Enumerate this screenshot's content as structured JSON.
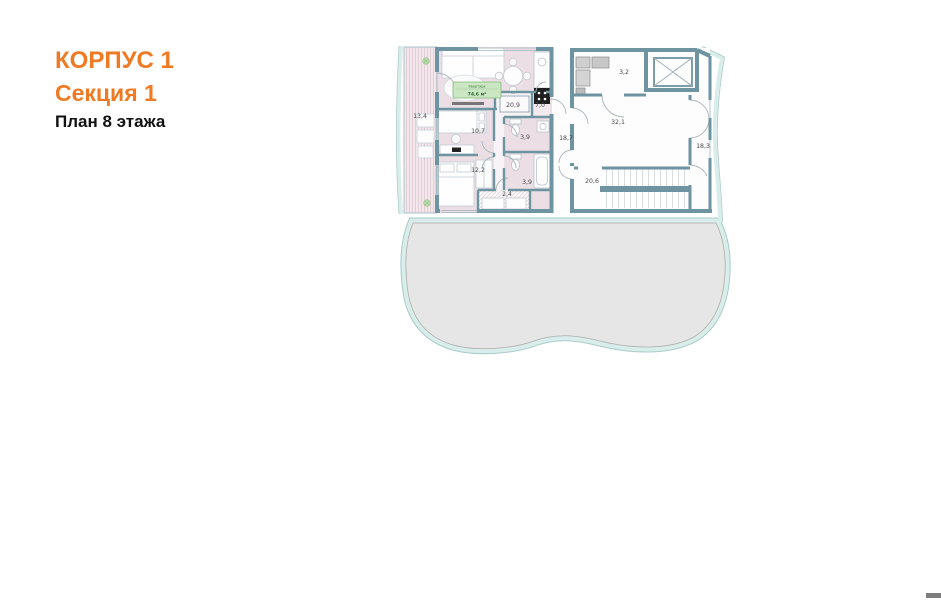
{
  "header": {
    "building": "КОРПУС 1",
    "section": "Секция 1",
    "floor": "План 8 этажа"
  },
  "plan": {
    "apartment_badge": {
      "title": "Квартира",
      "area": "74,6 м²"
    },
    "rooms": [
      {
        "name": "balcony",
        "area": "13,4"
      },
      {
        "name": "living-room",
        "area": "20,9"
      },
      {
        "name": "kitchen",
        "area": "7,0"
      },
      {
        "name": "bedroom-1",
        "area": "10,7"
      },
      {
        "name": "bathroom-1",
        "area": "3,9"
      },
      {
        "name": "bedroom-2",
        "area": "12,2"
      },
      {
        "name": "bathroom-2",
        "area": "3,9"
      },
      {
        "name": "wardrobe",
        "area": "2,4"
      },
      {
        "name": "corridor-left",
        "area": "18,7"
      },
      {
        "name": "elevator-hall",
        "area": "32,1"
      },
      {
        "name": "utility",
        "area": "3,2"
      },
      {
        "name": "corridor-right",
        "area": "18,3"
      },
      {
        "name": "stairwell",
        "area": "20,6"
      }
    ]
  },
  "colors": {
    "accent_orange": "#EE7A23",
    "wall": "#6E93A1",
    "apartment_fill": "#EBDFE5",
    "balcony_fill": "#F3E7EC",
    "terrace_fill": "#E7E6E6",
    "terrace_band": "#D9EDEB",
    "badge_fill": "#CBE6C3",
    "badge_border": "#82BA78"
  }
}
